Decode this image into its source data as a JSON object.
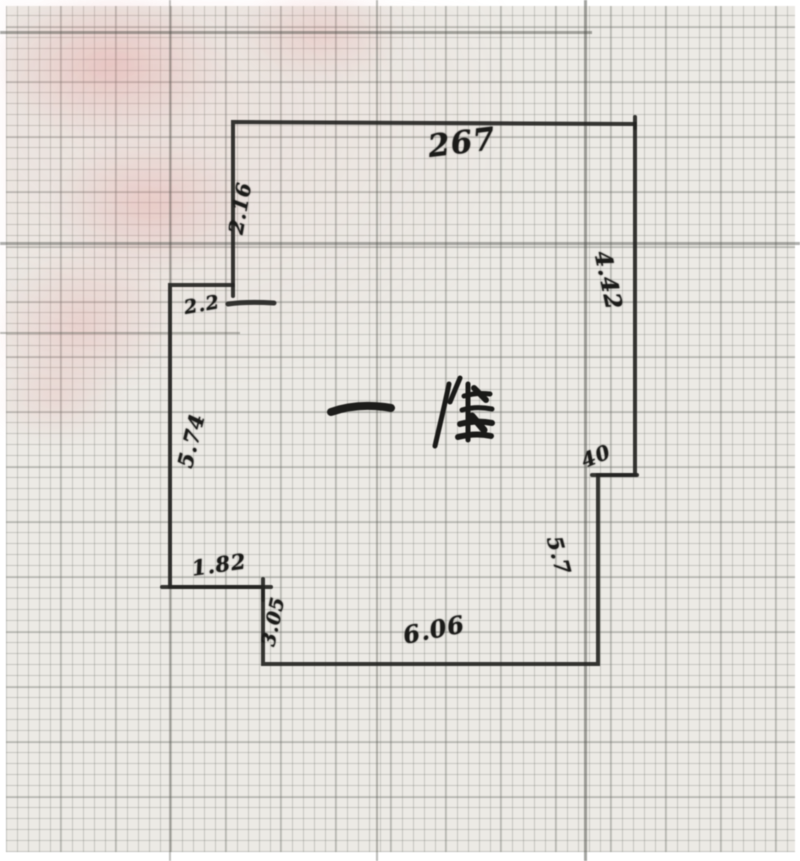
{
  "floor_plan": {
    "center_annotation": {
      "dash": "一",
      "character": "階"
    },
    "dimensions": {
      "top_edge": "267",
      "upper_left_wall": "2.16",
      "left_jog": "2.2",
      "left_wall": "5.74",
      "upper_right_wall": "4.42",
      "right_jog": "40",
      "lower_right_wall": "5.7",
      "bottom_edge": "6.06",
      "lower_left_step": "1.82",
      "lower_left_wall": "3.05"
    }
  },
  "colors": {
    "paper": "#eae8e3",
    "ink": "#262624",
    "grid_line": "#8b8e88",
    "heavy_rule": "#55574f",
    "red_pencil": "#dc9c9c"
  }
}
